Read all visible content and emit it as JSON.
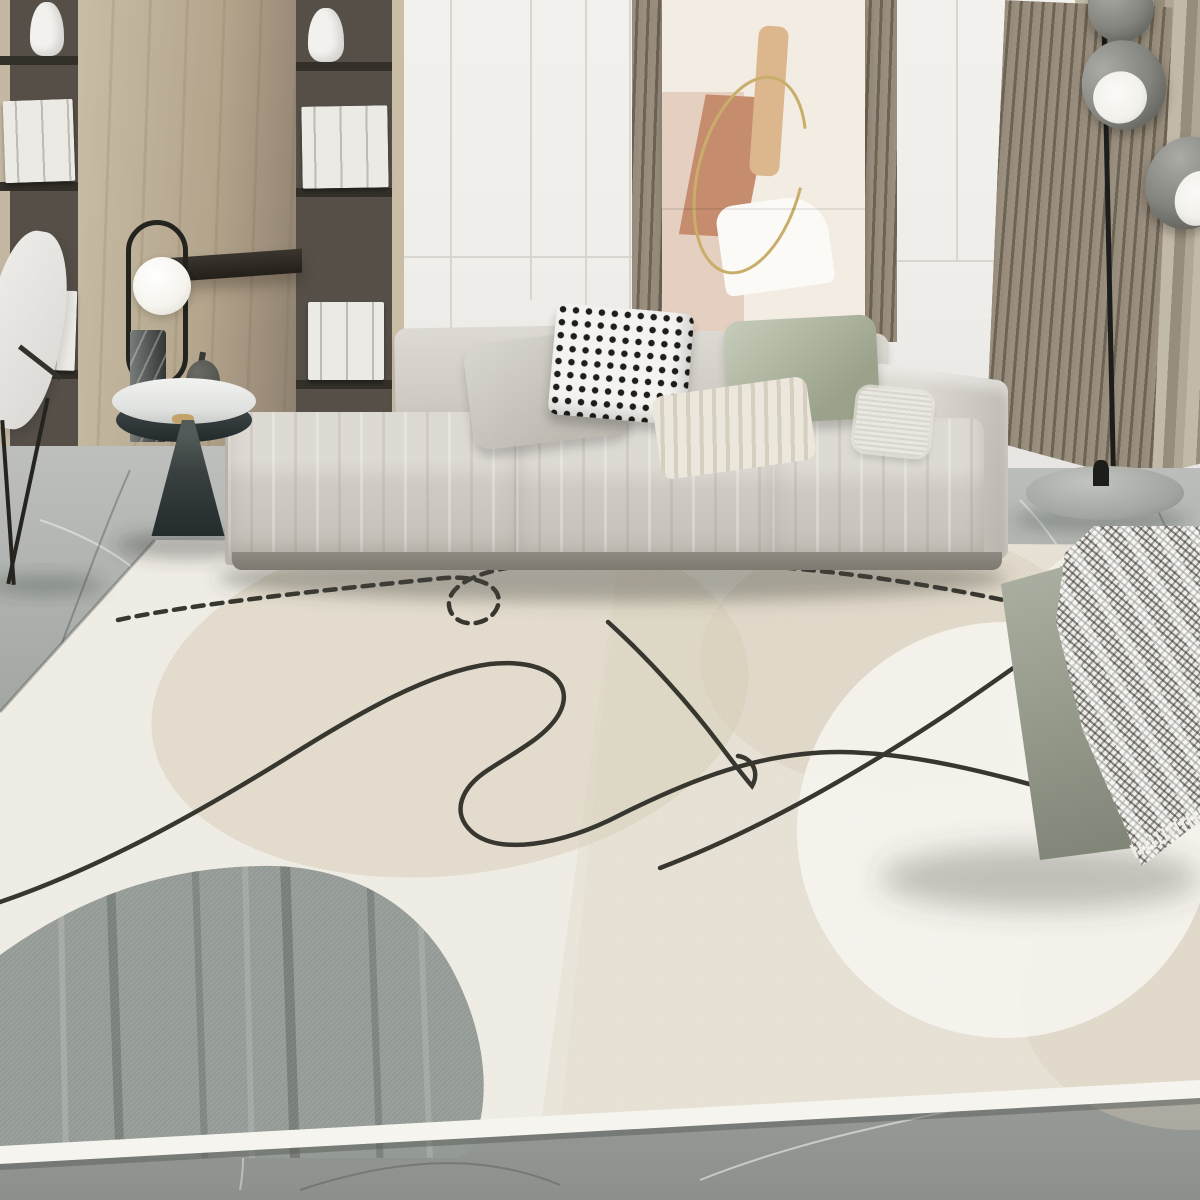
{
  "meta": {
    "title": "Abstract line-art area rug in modern living room",
    "alt": "Lifestyle product photo of a beige abstract area rug with black continuous line doodle, gray and beige organic blobs and a white circle, placed on gray marble floor in a minimalist living room with a light gray modular sofa, pillows, wooden shelving, leaning wall art, wood slat panels, a curtain, a dome floor lamp, a round side table with sculptural lamp, and a gray-green ottoman with a checkered throw blanket",
    "room_style": "minimalist modern living room",
    "image_type": "product lifestyle photograph, no visible text"
  },
  "palette": {
    "wall": "#efede9",
    "wall_seam": "#d9d6d0",
    "wood_light": "#c9bda6",
    "wood_mid": "#b3a48c",
    "wood_shadow": "#8f8170",
    "shelf_dark": "#554f48",
    "shelf_board": "#332f29",
    "book_white": "#eceae5",
    "vase_white": "#f2f1ee",
    "slat_light": "#9a8f7e",
    "slat_dark": "#6e6455",
    "art_bg": "#f2ece3",
    "art_pink": "#e4cfc0",
    "art_terracotta": "#c58c6d",
    "art_tan": "#dcb68c",
    "art_white": "#fbfaf7",
    "art_gold": "#c9ae6b",
    "curtain_light": "#c2baa9",
    "curtain_mid": "#b0a796",
    "curtain_dark": "#968d7c",
    "dome_gray": "#84847f",
    "dome_white": "#f2f1ec",
    "lamp_black": "#1d1d1b",
    "lamp_base_gray": "#a2a5a0",
    "chair_white": "#eeedea",
    "table_top": "#f2f3f1",
    "table_cone_dark": "#242b2d",
    "table_cone_light": "#525b59",
    "gold": "#c2a268",
    "lamp_marble": "#4b524e",
    "globe_white": "#f6f4ee",
    "stone_gray": "#52524c",
    "sofa_light": "#ddd9d3",
    "sofa_mid": "#cfcbc4",
    "sofa_dark": "#b7b3ab",
    "sofa_shadow": "#8e8a82",
    "pillow_gray_l": "#d9d6d0",
    "pillow_gray_d": "#bebab2",
    "check_base": "#f4f3f0",
    "check_dot": "#1e1e1c",
    "sage_l": "#c6cdba",
    "sage_d": "#9aa28c",
    "stripe_l": "#ece7dc",
    "stripe_d": "#d6cfc0",
    "fringe_white": "#e9e7e0",
    "marble": "#a3a7a3",
    "rug_cream": "#e8e4d8",
    "rug_beige": "#d6cbb6",
    "rug_white": "#f4f2ec",
    "rug_gray": "#949a95",
    "rug_line": "#37362f",
    "rug_border": "#f6f4ee",
    "ottoman_l": "#adb1a3",
    "ottoman_d": "#7f8376",
    "blanket_base": "#eeece6",
    "blanket_check": "#232320"
  },
  "objects": [
    {
      "name": "bookshelf-wall",
      "desc": "built-in wood shelving with white books and two white sculptural vases, dark shelf boards"
    },
    {
      "name": "wood-panel",
      "desc": "light oak wall panel between shelf columns with a dark floating shelf"
    },
    {
      "name": "lounge-chair",
      "desc": "white shell chair with thin black legs, partially visible at far left"
    },
    {
      "name": "side-table",
      "desc": "round white-top pedestal table with dark tapered cone base and gold ring collar"
    },
    {
      "name": "table-lamp",
      "desc": "sculptural lamp with black oval ring, white glass globe and green marble cylinder base"
    },
    {
      "name": "decor-stone",
      "desc": "small dark stone object on table"
    },
    {
      "name": "decor-books",
      "desc": "white stacked books on table"
    },
    {
      "name": "wall-art",
      "desc": "leaning abstract print with pink, terracotta and tan shapes plus thin gold oval line"
    },
    {
      "name": "slat-panels",
      "desc": "vertical wood slat accent panels flanking the art and beside the curtain"
    },
    {
      "name": "curtain",
      "desc": "taupe floor curtain at right"
    },
    {
      "name": "floor-lamp",
      "desc": "black pole floor lamp with three gray dome shades and round gray base"
    },
    {
      "name": "sofa",
      "desc": "light greige low modular fabric sofa, three seat cushions, right armrest"
    },
    {
      "name": "pillow-gray",
      "desc": "plain light gray cushion"
    },
    {
      "name": "pillow-checkered",
      "desc": "black and white mini-check cushion"
    },
    {
      "name": "pillow-sage-green",
      "desc": "sage green velvet cushion"
    },
    {
      "name": "pillow-striped",
      "desc": "beige and cream striped cushion"
    },
    {
      "name": "pillow-fringed",
      "desc": "small white textured cushion near armrest"
    },
    {
      "name": "area-rug",
      "desc": "cream abstract rug: black single-line doodle with small circular loop, dotted segment, gray kidney blob bottom-left, beige blobs, large white circle right, pale border edge"
    },
    {
      "name": "ottoman",
      "desc": "gray-green rectangular ottoman bench on rug at right"
    },
    {
      "name": "throw-blanket",
      "desc": "black-white houndstooth check fringed throw draped over ottoman"
    },
    {
      "name": "marble-floor",
      "desc": "gray marble tile floor with white veining"
    }
  ]
}
